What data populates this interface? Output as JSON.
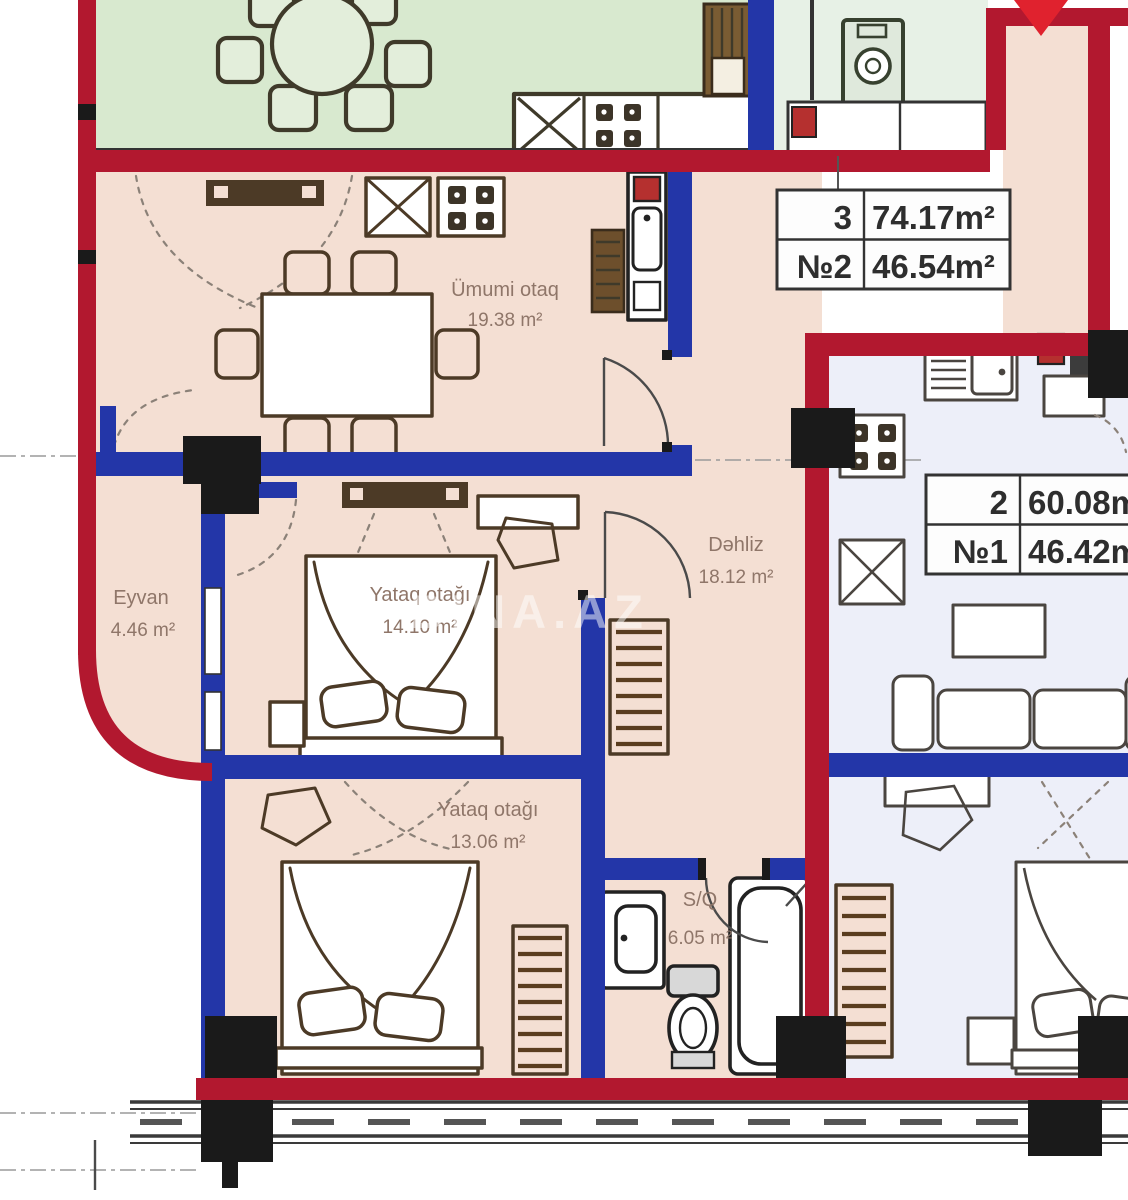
{
  "watermark": {
    "text": "BINA.AZ"
  },
  "info_tables": {
    "apt2": {
      "col1": [
        "3",
        "№2"
      ],
      "col2": [
        "74.17m²",
        "46.54m²"
      ]
    },
    "apt1": {
      "col1": [
        "2",
        "№1"
      ],
      "col2": [
        "60.08m²",
        "46.42m²"
      ]
    }
  },
  "rooms": {
    "umumi_otaq": {
      "name": "Ümumi otaq",
      "area": "19.38 m²"
    },
    "dahliz": {
      "name": "Dəhliz",
      "area": "18.12 m²"
    },
    "eyvan": {
      "name": "Eyvan",
      "area": "4.46 m²"
    },
    "yataq_otagi_1": {
      "name": "Yataq otağı",
      "area": "14.10 m²"
    },
    "yataq_otagi_2": {
      "name": "Yataq otağı",
      "area": "13.06 m²"
    },
    "sq": {
      "name": "S/Q",
      "area": "6.05 m²"
    }
  },
  "colors": {
    "wall_exterior": "#b2182f",
    "wall_interior": "#2336a8",
    "column": "#1a1a1a",
    "room_apartment2": "#f4dfd3",
    "room_apartment1": "#edeff9",
    "room_green": "#d8e9cf",
    "entry_arrow": "#e0222e",
    "label_text": "#8f7669",
    "watermark_text": "#ffffff"
  }
}
